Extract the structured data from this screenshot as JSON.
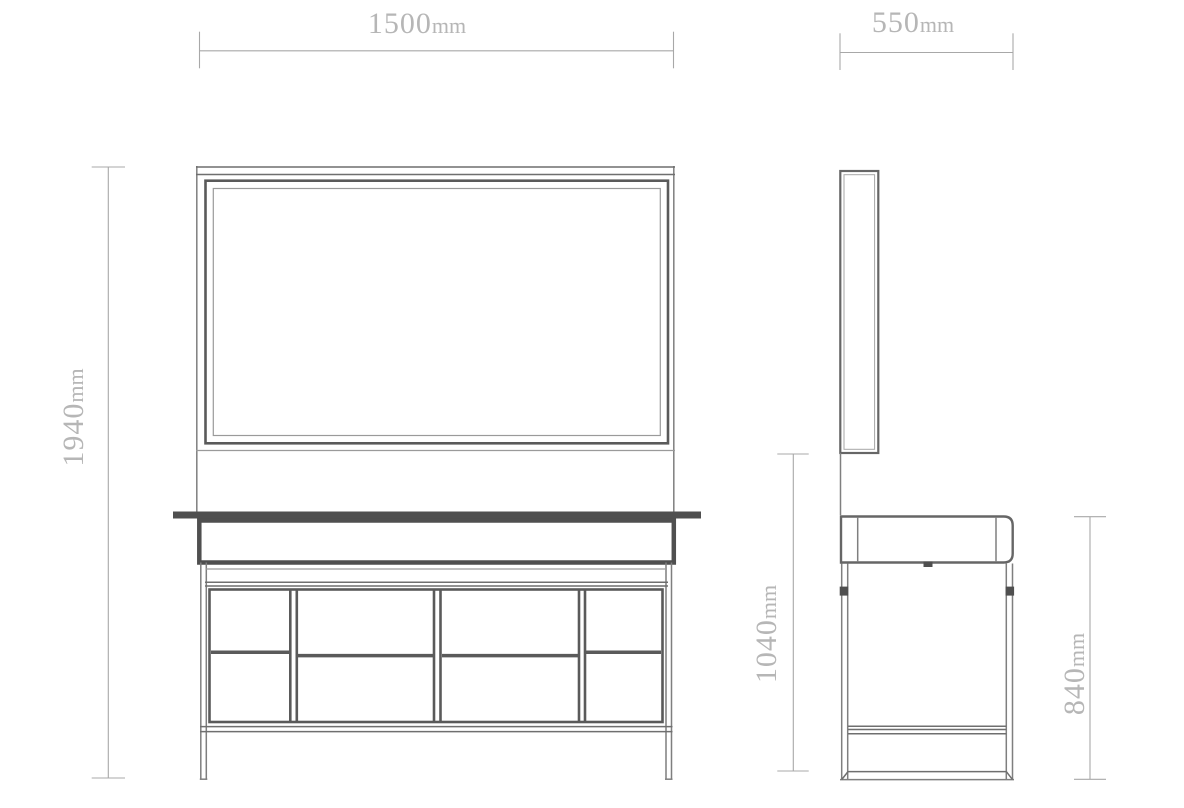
{
  "drawing": {
    "type": "furniture-technical-drawing",
    "dimensions": {
      "front_width": {
        "label": "1500",
        "unit": "mm",
        "value_mm": 1500
      },
      "side_depth": {
        "label": "550",
        "unit": "mm",
        "value_mm": 550
      },
      "total_height": {
        "label": "1940",
        "unit": "mm",
        "value_mm": 1940
      },
      "mirror_bottom_to_floor": {
        "label": "1040",
        "unit": "mm",
        "value_mm": 1040
      },
      "counter_height": {
        "label": "840",
        "unit": "mm",
        "value_mm": 840
      }
    },
    "colors": {
      "background": "#ffffff",
      "outline_thin": "#7f7f7f",
      "outline_frame": "#5a5a5a",
      "dark_accent": "#4f4f4f",
      "dimension_line": "#a8a8a8",
      "dimension_text": "#b6b6b6"
    }
  }
}
